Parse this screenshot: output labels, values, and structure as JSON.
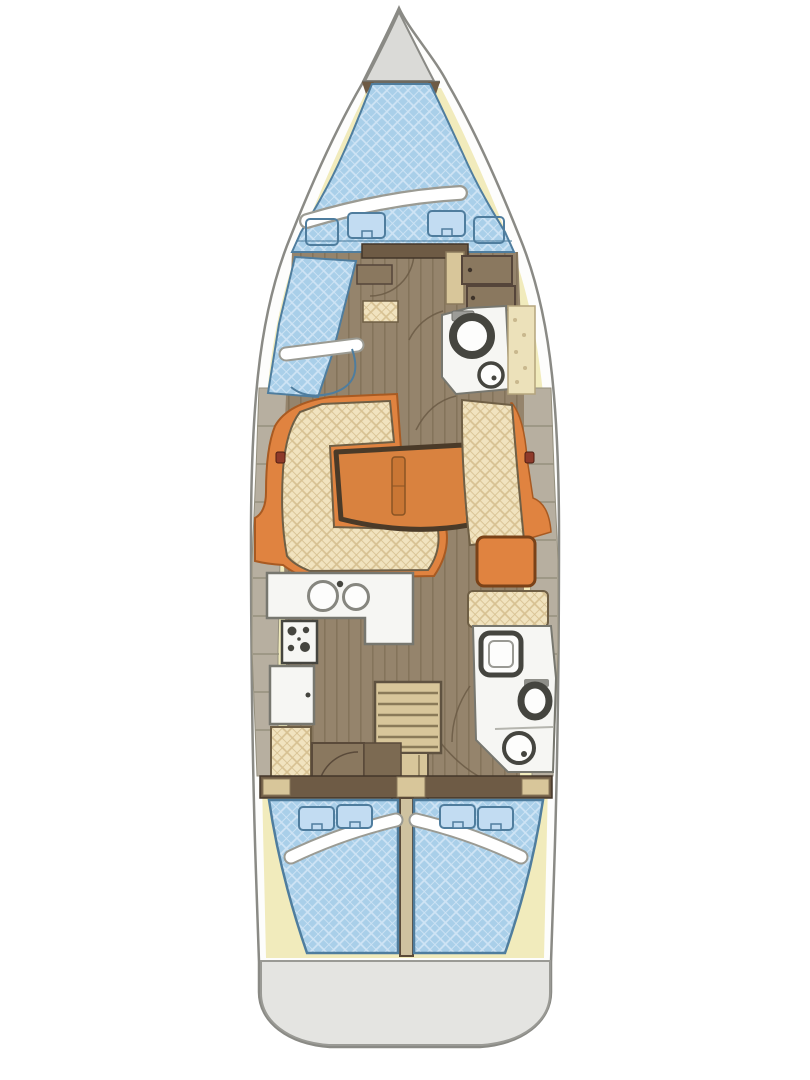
{
  "scene": {
    "type": "sailboat-interior-floor-plan",
    "orientation": "bow-up",
    "visible_text": []
  },
  "colors": {
    "background": "#ffffff",
    "hull_fill": "#fdfdfc",
    "hull_stroke": "#8a8a85",
    "foredeck_fill": "#dadad7",
    "deck_fill": "#f1ebbc",
    "mattress_blue": "#a9cfe9",
    "mattress_blue_line": "#cfe4f5",
    "mattress_stroke": "#4f7d9e",
    "pillow_blue": "#c2dcf2",
    "band_white": "#ffffff",
    "band_shadow": "#9b9b93",
    "wood_floor": "#95846c",
    "wood_plank_line": "#6d5c45",
    "upholstery_cream": "#f1e3bf",
    "upholstery_line": "#d7c192",
    "upholstery_stroke": "#6f5f45",
    "accent_orange": "#e08340",
    "accent_orange_dark": "#a85a22",
    "table_orange": "#d9823f",
    "table_border": "#4a3a28",
    "table_leaf": "#c97634",
    "cabinet_brown": "#8a785f",
    "cabinet_brown_dark": "#6e5b45",
    "fixture_white": "#f6f6f3",
    "fixture_stroke": "#77776f",
    "fixture_dark": "#45453f",
    "side_wall": "#b7afa0",
    "side_wall_line": "#95907e",
    "stair_tan": "#d8c69a",
    "stair_line": "#8a7a58",
    "divider_tan": "#cfc2a0",
    "stern_fill": "#e4e4e1",
    "stern_stroke": "#9a9a95",
    "fitting_red": "#8e3a2a",
    "shelf_cream": "#ece1ba",
    "arc_line": "#6b5b45"
  },
  "parts": [
    "hull",
    "anchor-locker",
    "side-deck",
    "v-berth",
    "bow-pillows",
    "port-sea-berth",
    "forward-head-toilet",
    "forward-head-sink",
    "wardrobe",
    "hanging-locker",
    "salon-sofa-port",
    "salon-sofa-starboard",
    "dining-table",
    "chart-table",
    "nav-seat",
    "galley-counter",
    "galley-sink",
    "stove",
    "fridge",
    "companionway-steps",
    "aft-head-shower",
    "aft-head-toilet",
    "aft-head-sink",
    "aft-cabin-port-berth",
    "aft-cabin-starboard-berth",
    "stern-platform"
  ]
}
